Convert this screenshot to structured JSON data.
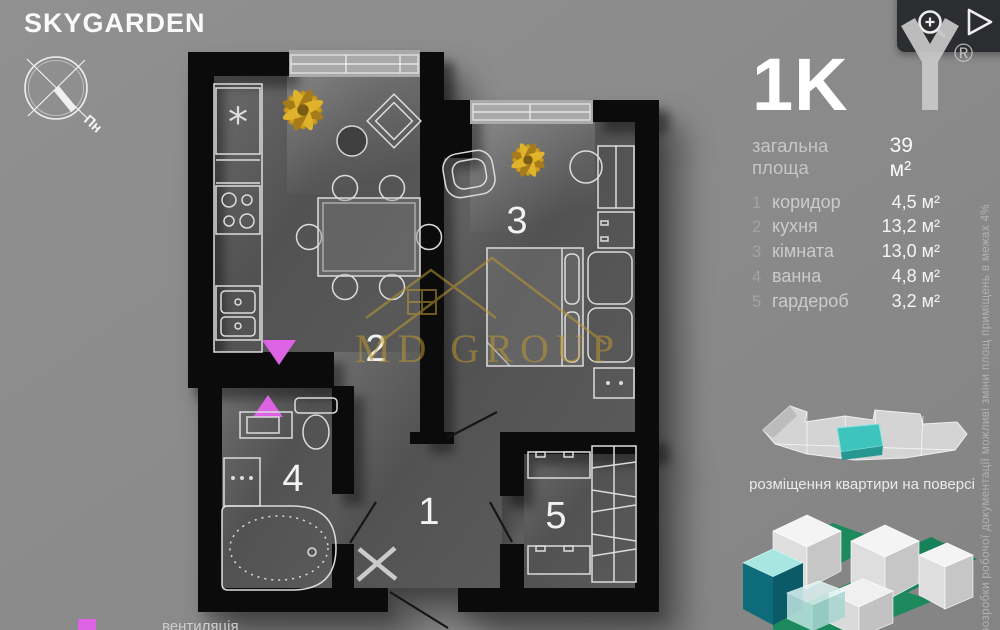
{
  "header": {
    "logo": "SKYGARDEN",
    "compass_north": "Пн"
  },
  "viewer_toolbar": {
    "zoom_icon": "zoom-in-magnifier",
    "play_icon": "play-triangle",
    "registered_mark": "®",
    "brand_letter": "Y"
  },
  "plan": {
    "watermark": "MD GROUP",
    "legend": {
      "vent_label": "вентиляція"
    }
  },
  "info_panel": {
    "type_title": "1K",
    "total_area_label": "загальна площа",
    "total_area_value": "39 м²",
    "rooms": [
      {
        "num": "1",
        "name": "коридор",
        "area": "4,5 м²"
      },
      {
        "num": "2",
        "name": "кухня",
        "area": "13,2 м²"
      },
      {
        "num": "3",
        "name": "кімната",
        "area": "13,0 м²"
      },
      {
        "num": "4",
        "name": "ванна",
        "area": "4,8 м²"
      },
      {
        "num": "5",
        "name": "гардероб",
        "area": "3,2 м²"
      }
    ],
    "floor_diagram_caption": "розміщення квартири на поверсі",
    "disclaimer": "розробки робочої документації можливі зміни площ приміщень в межах 4%"
  },
  "colors": {
    "vent_magenta": "#dd63e4",
    "watermark_gold": "#bd9830",
    "highlight_teal": "#3fc4bd",
    "courtyard_green": "#1d8a5e"
  }
}
